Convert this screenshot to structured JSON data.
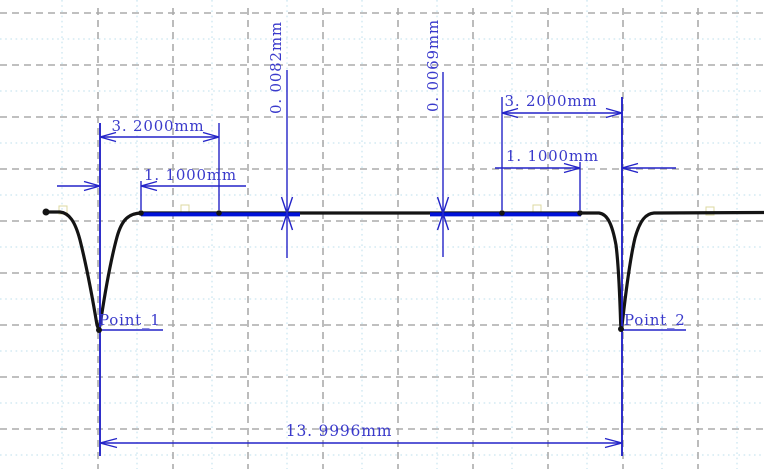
{
  "chart_data": {
    "type": "line",
    "title": "",
    "description": "Surface profile measurement trace with two groove points and CAD-style blue dimension annotations over a dashed grid",
    "unit": "mm",
    "grid": true,
    "points": [
      {
        "name": "Point_1",
        "label": "Point_1",
        "feature": "left groove (sharp V dip in profile)"
      },
      {
        "name": "Point_2",
        "label": "Point_2",
        "feature": "right groove (sharp V dip in profile)"
      }
    ],
    "dimensions": [
      {
        "id": "left_width",
        "label": "3. 2000mm",
        "value_mm": 3.2,
        "orientation": "horizontal",
        "measures": "Point_1 to end of left highlighted segment"
      },
      {
        "id": "left_inner",
        "label": "1. 1000mm",
        "value_mm": 1.1,
        "orientation": "horizontal",
        "measures": "Point_1 to start of left highlighted segment"
      },
      {
        "id": "left_height",
        "label": "0. 0082mm",
        "value_mm": 0.0082,
        "orientation": "vertical",
        "measures": "step height at end of left segment"
      },
      {
        "id": "right_height",
        "label": "0. 0069mm",
        "value_mm": 0.0069,
        "orientation": "vertical",
        "measures": "step height at start of right segment"
      },
      {
        "id": "right_width",
        "label": "3. 2000mm",
        "value_mm": 3.2,
        "orientation": "horizontal",
        "measures": "start of right highlighted segment to Point_2"
      },
      {
        "id": "right_inner",
        "label": "1. 1000mm",
        "value_mm": 1.1,
        "orientation": "horizontal",
        "measures": "end of right highlighted segment to Point_2"
      },
      {
        "id": "total_span",
        "label": "13. 9996mm",
        "value_mm": 13.9996,
        "orientation": "horizontal",
        "measures": "Point_1 to Point_2"
      }
    ]
  },
  "labels": {
    "point1": "Point_1",
    "point2": "Point_2",
    "left_32": "3. 2000mm",
    "left_11": "1. 1000mm",
    "height_82": "0. 0082mm",
    "height_69": "0. 0069mm",
    "right_32": "3. 2000mm",
    "right_11": "1. 1000mm",
    "total": "13. 9996mm"
  },
  "colors": {
    "dimension_blue": "#2424c8",
    "text_blue": "#3a3acb",
    "segment_blue": "#0012d8",
    "curve_black": "#141414",
    "grid_gray": "#ababab",
    "grid_cyan": "#bedfec",
    "grip_yellow": "#ddd9a0"
  }
}
